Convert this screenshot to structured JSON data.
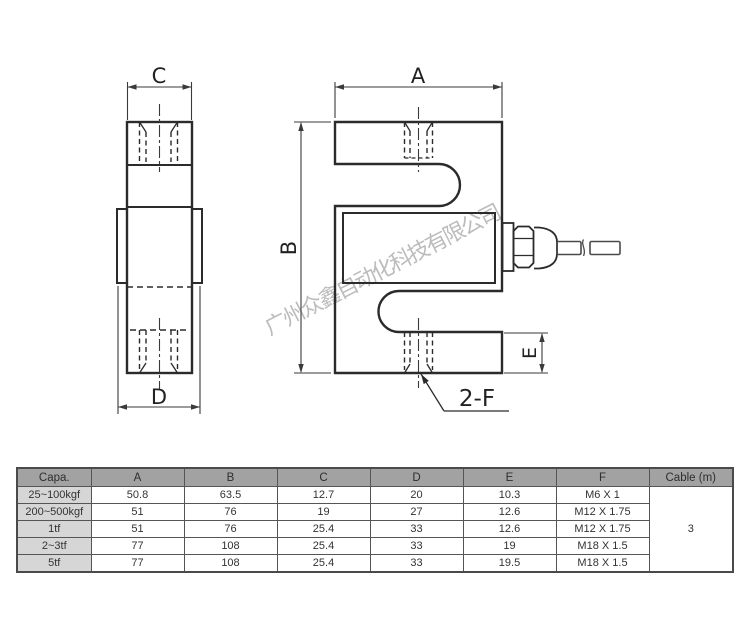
{
  "watermark": {
    "text": "广州众鑫自动化科技有限公司"
  },
  "drawing": {
    "dim_labels": {
      "a": "A",
      "b": "B",
      "c": "C",
      "d": "D",
      "e": "E"
    },
    "thread_callout": "2-F"
  },
  "spec_table": {
    "headers": [
      "Capa.",
      "A",
      "B",
      "C",
      "D",
      "E",
      "F",
      "Cable (m)"
    ],
    "rows": [
      [
        "25~100kgf",
        "50.8",
        "63.5",
        "12.7",
        "20",
        "10.3",
        "M6 X 1"
      ],
      [
        "200~500kgf",
        "51",
        "76",
        "19",
        "27",
        "12.6",
        "M12 X 1.75"
      ],
      [
        "1tf",
        "51",
        "76",
        "25.4",
        "33",
        "12.6",
        "M12 X 1.75"
      ],
      [
        "2~3tf",
        "77",
        "108",
        "25.4",
        "33",
        "19",
        "M18 X 1.5"
      ],
      [
        "5tf",
        "77",
        "108",
        "25.4",
        "33",
        "19.5",
        "M18 X 1.5"
      ]
    ],
    "cable_length": "3"
  },
  "colors": {
    "outline": "#2b2b2b",
    "dim_line": "#3a3a3a",
    "header_bg": "#a2a2a2",
    "row_label_bg": "#d6d6d6",
    "watermark": "#bcbcbc"
  }
}
